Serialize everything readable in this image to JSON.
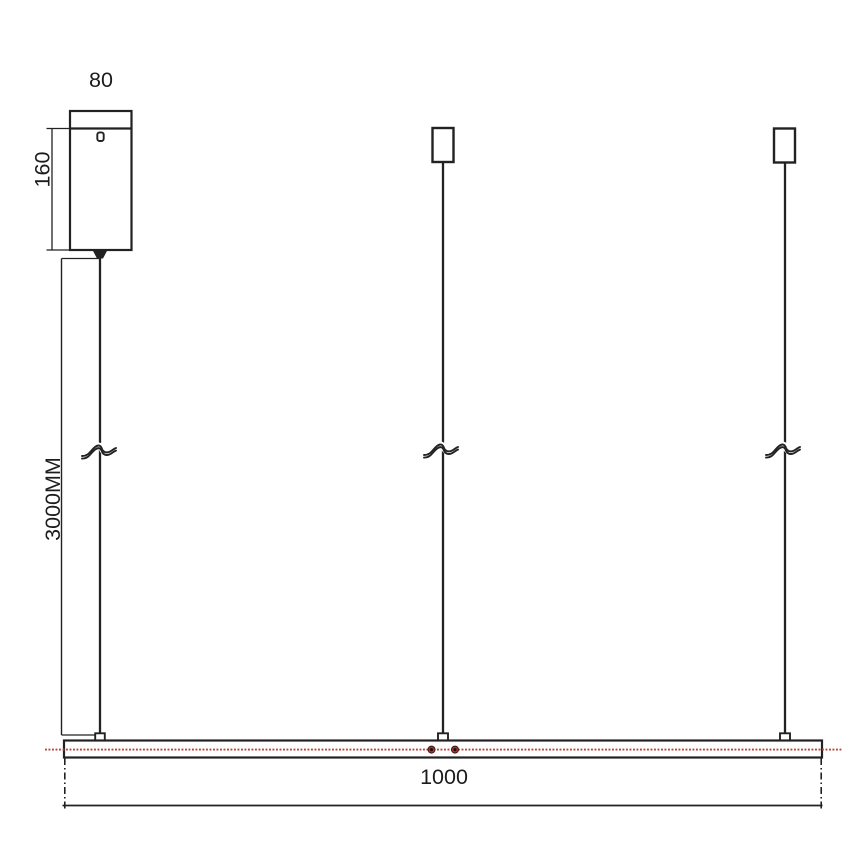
{
  "drawing": {
    "colors": {
      "ink": "#222222",
      "accent_red": "#b5413a",
      "dot_ring": "#a63a31",
      "dot_core": "#2a0f0d"
    },
    "dimensions": {
      "canopy_width": "80",
      "canopy_height": "160",
      "cable_length": "3000MM",
      "bar_length": "1000"
    }
  }
}
